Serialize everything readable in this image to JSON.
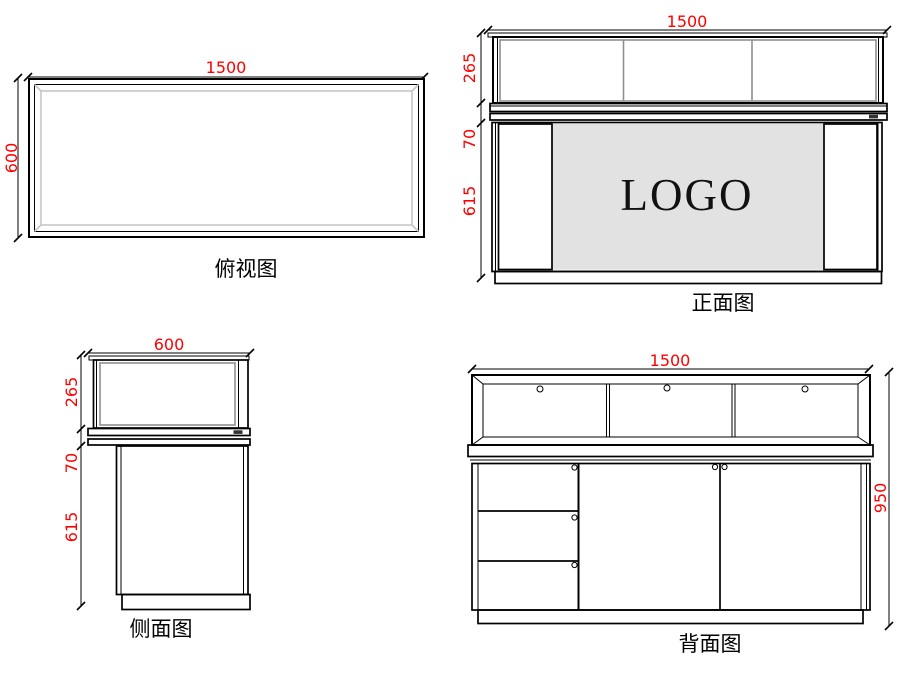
{
  "drawing_title": "display-counter-orthographic-views",
  "colors": {
    "dimension_text": "#ff0000",
    "line": "#000000",
    "glass_outline": "#8f8f8f",
    "logo_panel": "#e2e2e2",
    "background": "#ffffff"
  },
  "views": {
    "top": {
      "label": "俯视图",
      "dims": {
        "width": "1500",
        "depth": "600"
      }
    },
    "front": {
      "label": "正面图",
      "logo": "LOGO",
      "dims": {
        "width": "1500",
        "upper": "265",
        "counter": "70",
        "lower": "615"
      }
    },
    "side": {
      "label": "侧面图",
      "dims": {
        "depth": "600",
        "upper": "265",
        "counter": "70",
        "lower": "615"
      }
    },
    "back": {
      "label": "背面图",
      "dims": {
        "width": "1500",
        "height": "950"
      }
    }
  }
}
